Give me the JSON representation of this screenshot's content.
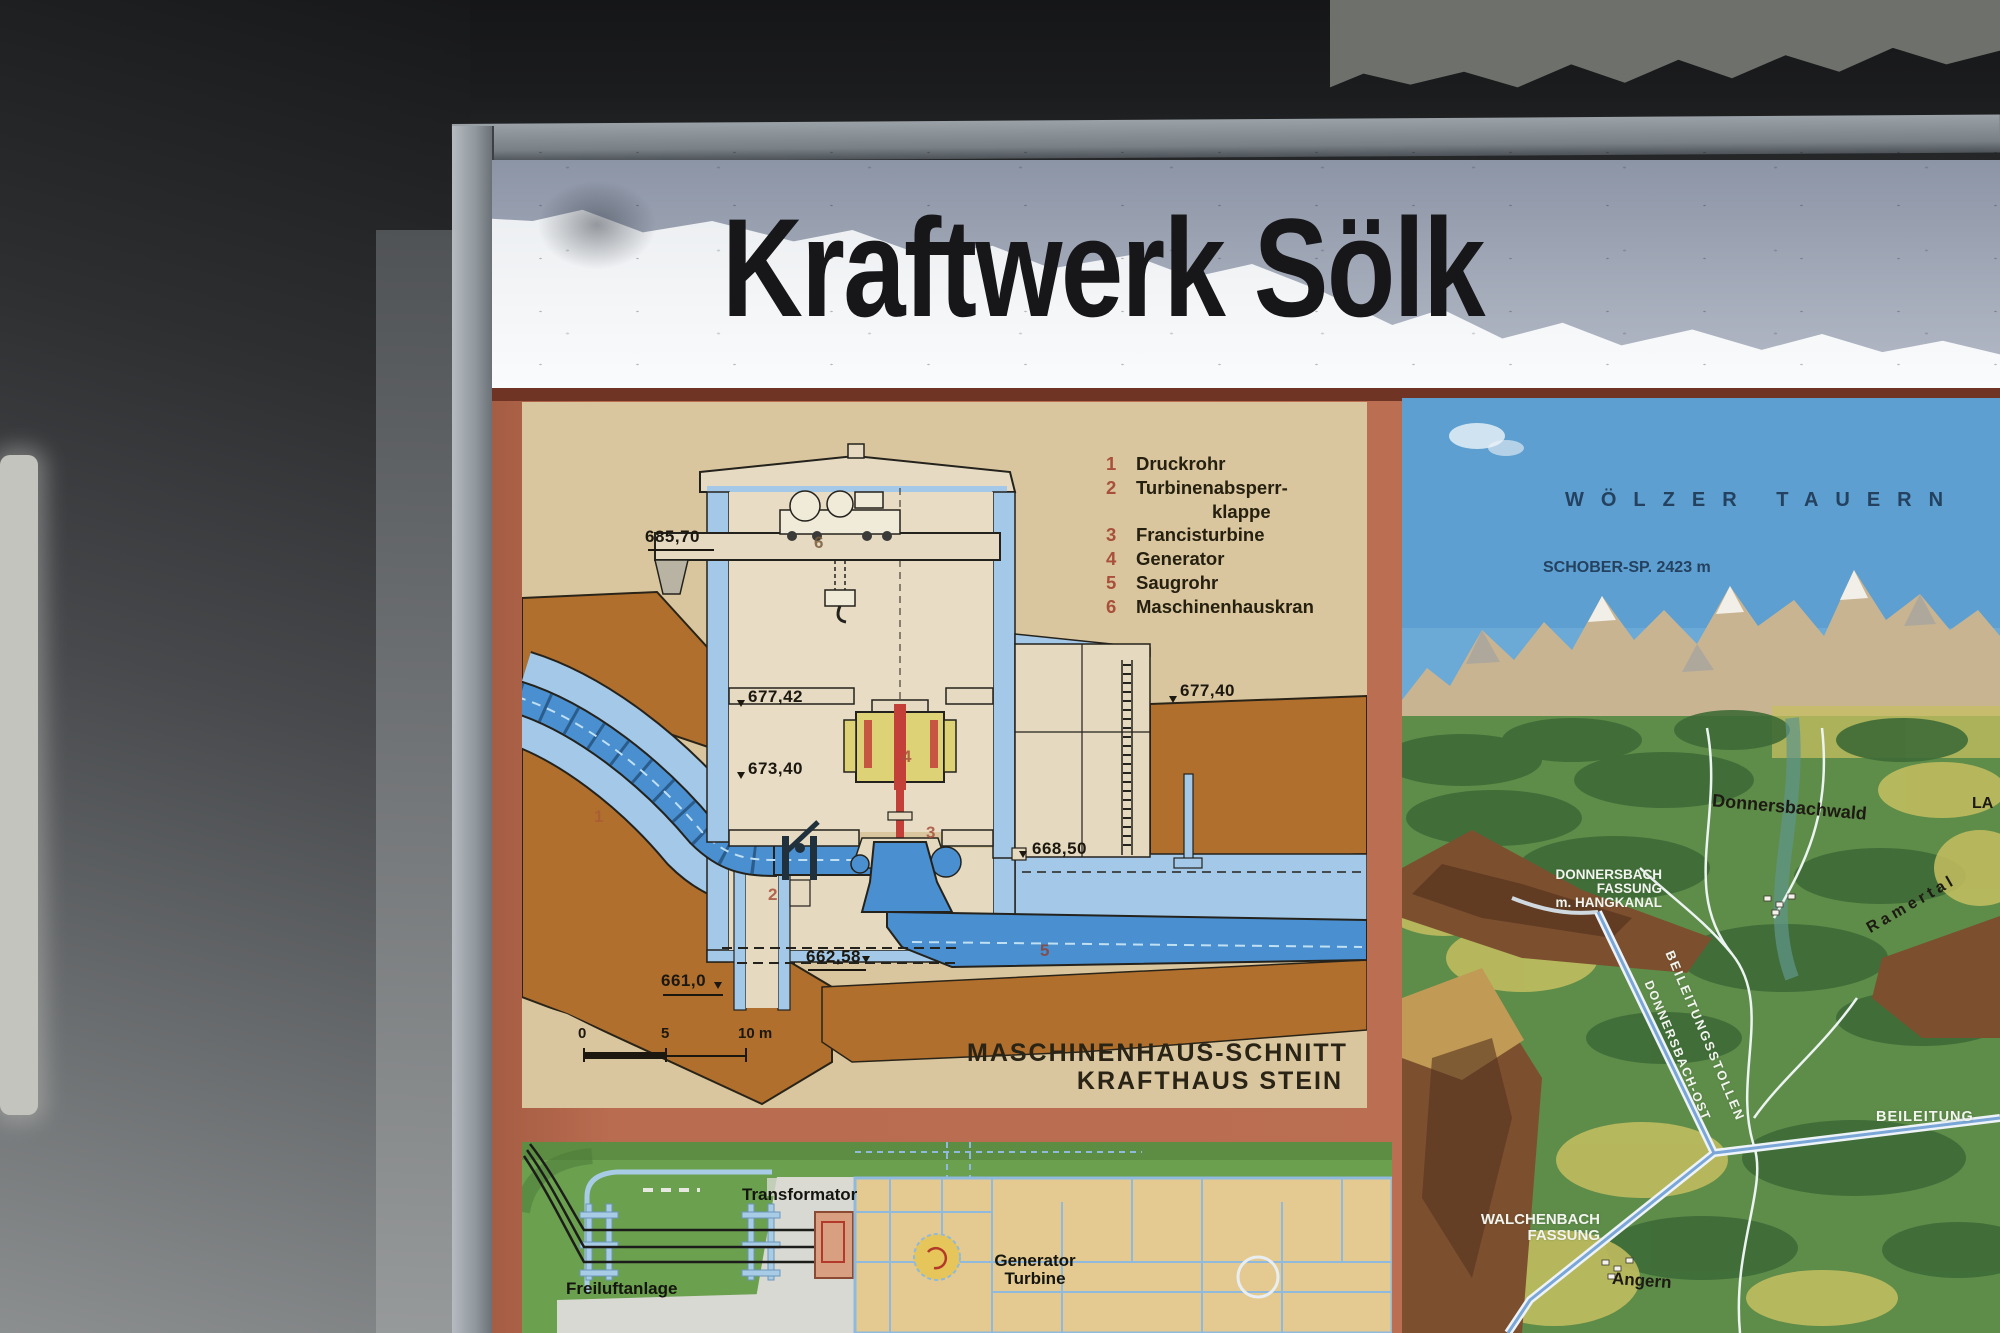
{
  "sign": {
    "title": "Kraftwerk Sölk"
  },
  "diagram": {
    "legend": [
      {
        "num": "1",
        "label": "Druckrohr"
      },
      {
        "num": "2",
        "label": "Turbinenabsperr-"
      },
      {
        "num": "",
        "label": "klappe"
      },
      {
        "num": "3",
        "label": "Francisturbine"
      },
      {
        "num": "4",
        "label": "Generator"
      },
      {
        "num": "5",
        "label": "Saugrohr"
      },
      {
        "num": "6",
        "label": "Maschinenhauskran"
      }
    ],
    "elevations": {
      "top": "685,70",
      "mid_left": "677,42",
      "low_left": "673,40",
      "right": "677,40",
      "tailwater": "668,50",
      "level": "662,58",
      "bottom": "661,0"
    },
    "marks": {
      "m1": "1",
      "m2": "2",
      "m3": "3",
      "m4": "4",
      "m5": "5",
      "m6": "6"
    },
    "caption_line1": "MASCHINENHAUS-SCHNITT",
    "caption_line2": "KRAFTHAUS STEIN",
    "scale": {
      "zero": "0",
      "five": "5",
      "ten": "10 m"
    }
  },
  "map": {
    "range": "WÖLZER TAUERN",
    "peak": "SCHOBER-SP. 2423 m",
    "village1": "Donnersbachwald",
    "fassung_line1": "DONNERSBACH",
    "fassung_line2": "FASSUNG",
    "fassung_line3": "m. HANGKANAL",
    "valley": "Ramertal",
    "stollen": "BEILEITUNGSSTOLLEN",
    "ost": "DONNERSBACH-OST",
    "beileitung": "BEILEITUNG",
    "walchenbach_line1": "WALCHENBACH",
    "walchenbach_line2": "FASSUNG",
    "village2": "Angern",
    "edge_label": "LA"
  },
  "site_plan": {
    "transformator": "Transformator",
    "freiluftanlage": "Freiluftanlage",
    "generator": "Generator",
    "turbine": "Turbine"
  },
  "colors": {
    "poster": "#b96c50",
    "panel_tan": "#d9c69e",
    "panel_green": "#6ba04f",
    "sky": "#5d9fd0",
    "ground_orange": "#b06f2d",
    "water_blue": "#4a8fd0",
    "structure_blue": "#a3c8e8",
    "legend_red": "#a8503c",
    "sign_white": "#f1f3f5"
  }
}
